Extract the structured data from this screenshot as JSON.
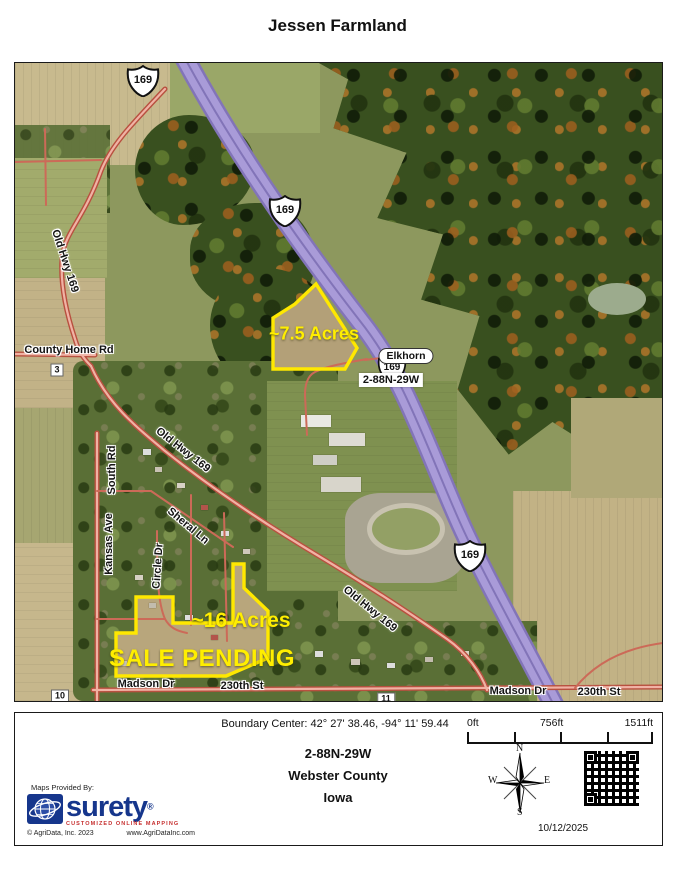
{
  "page": {
    "title": "Jessen Farmland"
  },
  "map": {
    "parcels": {
      "parcel1_acres": "~7.5 Acres",
      "parcel2_acres": "~16 Acres",
      "parcel2_status": "SALE PENDING"
    },
    "labels": {
      "place_elkhorn": "Elkhorn",
      "township": "2-88N-29W",
      "highway_shield": "169",
      "county_home_rd": "County Home Rd",
      "old_hwy_169": "Old Hwy 169",
      "south_rd": "South Rd",
      "kansas_ave": "Kansas Ave",
      "sheral_ln": "Sheral Ln",
      "circle_dr": "Circle Dr",
      "madson_dr": "Madson Dr",
      "street_230th": "230th St",
      "section_3": "3",
      "section_10": "10",
      "section_11": "11"
    }
  },
  "footer": {
    "boundary_center": "Boundary Center: 42° 27' 38.46, -94° 11' 59.44",
    "scale_bar": {
      "start": "0ft",
      "middle": "756ft",
      "end": "1511ft"
    },
    "township": "2-88N-29W",
    "county": "Webster County",
    "state": "Iowa",
    "provider": {
      "heading": "Maps Provided By:",
      "brand": "surety",
      "registered_mark": "®",
      "tagline": "CUSTOMIZED ONLINE MAPPING",
      "copyright": "© AgriData, Inc. 2023",
      "website": "www.AgriDataInc.com"
    },
    "compass": {
      "north": "N",
      "east": "E",
      "south": "S",
      "west": "W"
    },
    "date": "10/12/2025"
  },
  "colors": {
    "parcel_outline": "#FFE800",
    "highway_fill": "#A99BD8",
    "road_red": "#C95548",
    "brand_blue": "#16368C",
    "brand_red": "#C62F2F"
  }
}
